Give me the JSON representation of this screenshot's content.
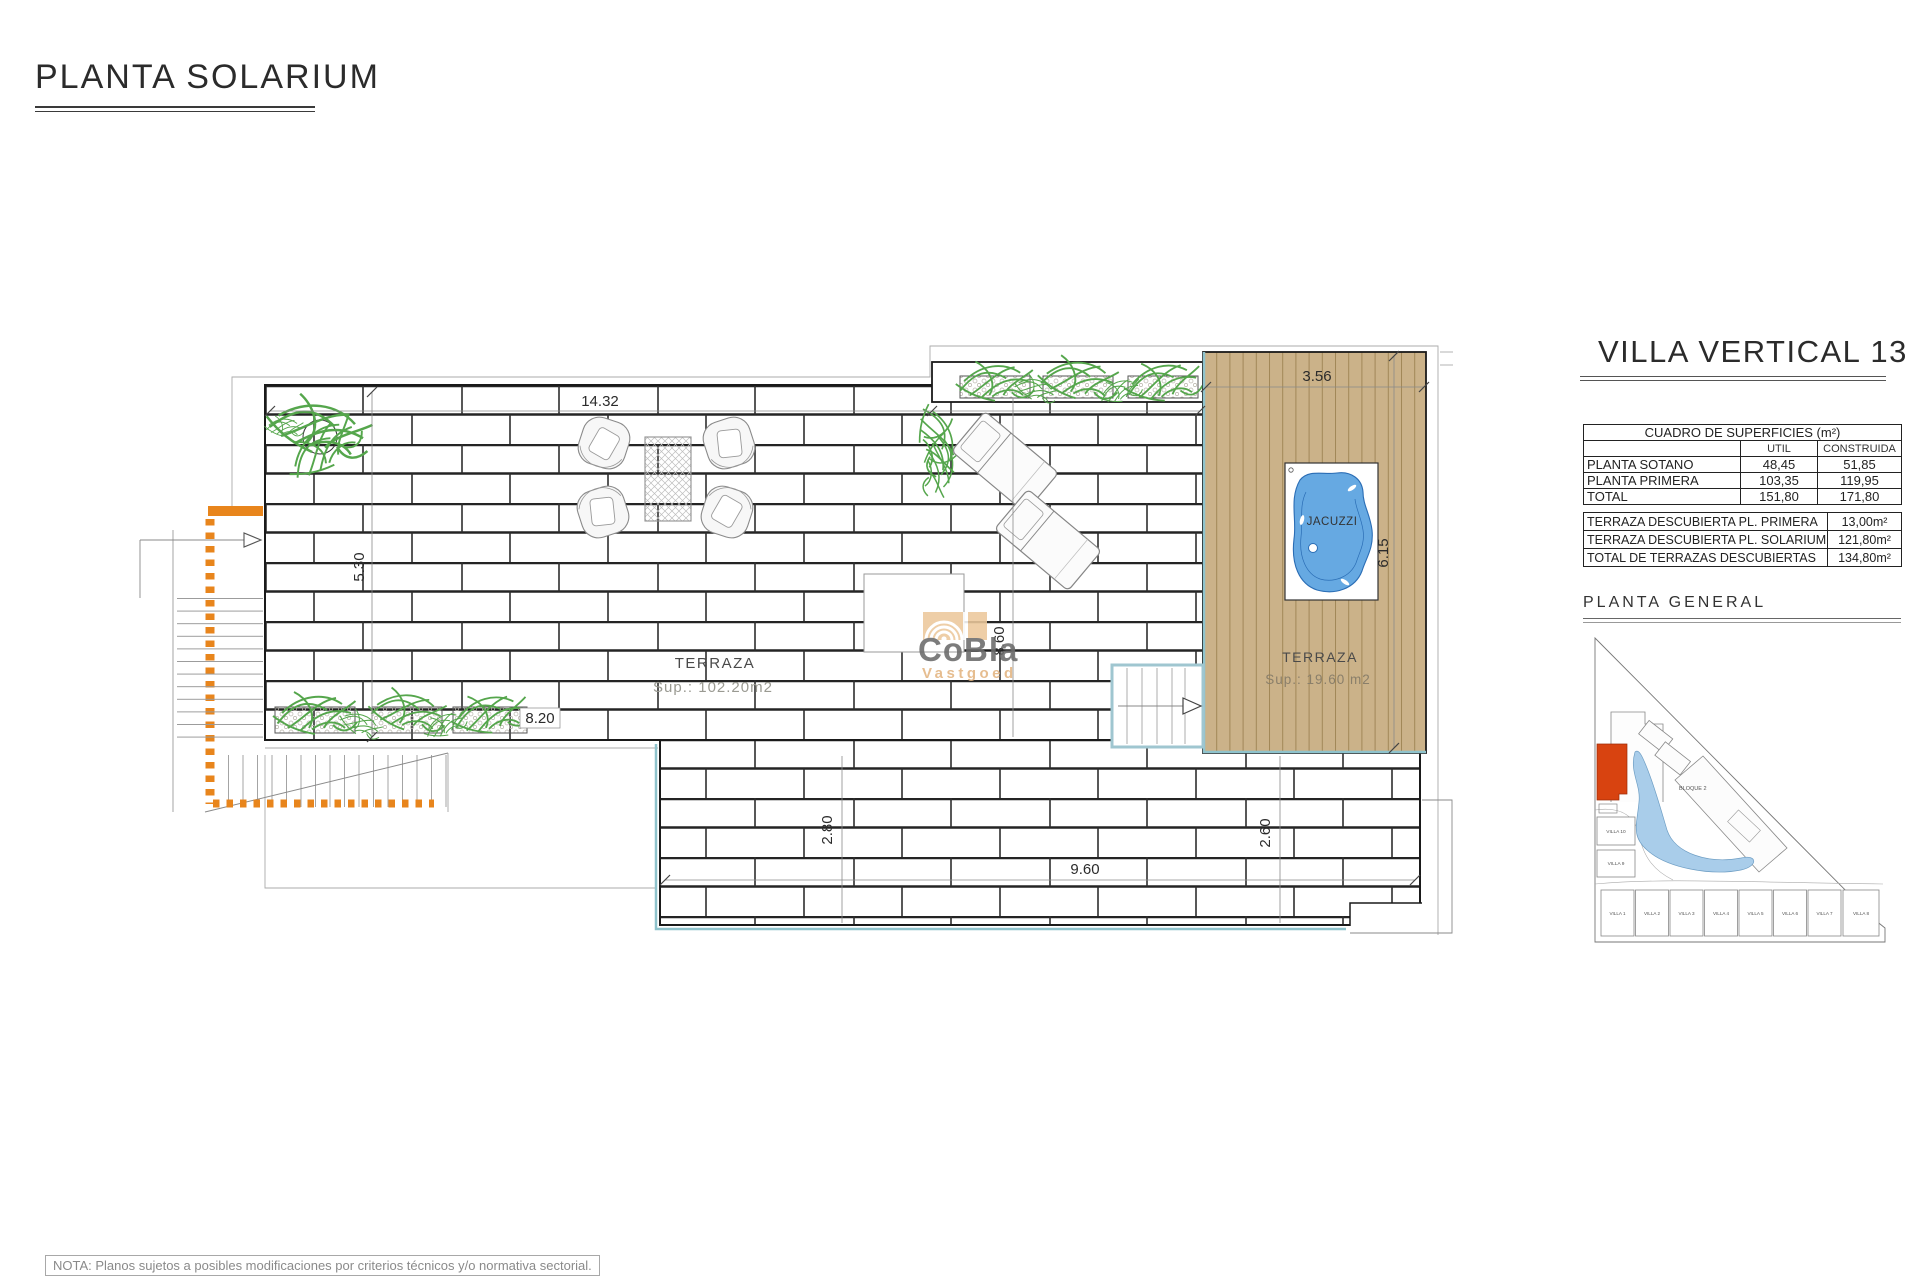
{
  "page": {
    "title": "PLANTA SOLARIUM",
    "note": "NOTA: Planos sujetos a posibles modificaciones por criterios técnicos y/o normativa sectorial."
  },
  "watermark": {
    "brand": "CoBla",
    "sub": "Vastgoed"
  },
  "plan": {
    "area_labels": {
      "terrace_main_title": "TERRAZA",
      "terrace_main_area": "Sup.: 102.20m2",
      "terrace_deck_title": "TERRAZA",
      "terrace_deck_area": "Sup.: 19.60 m2",
      "jacuzzi_label": "JACUZZI"
    },
    "dims": {
      "terrace_width": "14.32",
      "terrace_height": "5.30",
      "planter_row_width": "8.20",
      "terrace_mid_height": "8.60",
      "deck_width": "3.56",
      "deck_height": "6.15",
      "lower_terrace_left_height": "2.80",
      "lower_terrace_width": "9.60",
      "lower_terrace_right_height": "2.60"
    },
    "colors": {
      "deck_wood": "#cbb289",
      "pool_edge": "#8fc3cc",
      "jacuzzi_water": "#66a9e2",
      "plants": "#55a64c",
      "stair_accent": "#e8851c"
    }
  },
  "sidebar": {
    "villa_title": "VILLA VERTICAL 13",
    "surfaces_table": {
      "title": "CUADRO DE SUPERFICIES (m²)",
      "col_util": "UTIL",
      "col_construida": "CONSTRUIDA",
      "rows": [
        {
          "label": "PLANTA SOTANO",
          "util": "48,45",
          "construida": "51,85"
        },
        {
          "label": "PLANTA PRIMERA",
          "util": "103,35",
          "construida": "119,95"
        },
        {
          "label": "TOTAL",
          "util": "151,80",
          "construida": "171,80"
        }
      ]
    },
    "terraces_table": {
      "rows": [
        {
          "label": "TERRAZA DESCUBIERTA PL. PRIMERA",
          "value": "13,00m²"
        },
        {
          "label": "TERRAZA DESCUBIERTA PL. SOLARIUM",
          "value": "121,80m²"
        },
        {
          "label": "TOTAL DE TERRAZAS DESCUBIERTAS",
          "value": "134,80m²"
        }
      ]
    },
    "general_title": "PLANTA GENERAL",
    "site_map": {
      "bloque2_label": "BLOQUE 2",
      "left_villas": [
        "VILLA 10",
        "VILLA 9"
      ],
      "bottom_villas": [
        "VILLA 1",
        "VILLA 2",
        "VILLA 3",
        "VILLA 4",
        "VILLA 5",
        "VILLA 6",
        "VILLA 7",
        "VILLA 8"
      ]
    }
  }
}
